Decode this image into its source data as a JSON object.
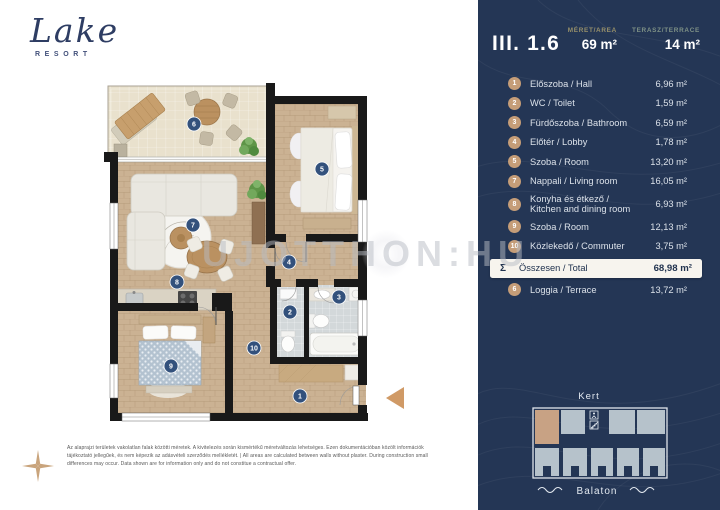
{
  "brand": {
    "name": "Lake",
    "sub": "RESORT"
  },
  "unit": {
    "id": "III. 1.6",
    "area_label": "MÉRET/AREA",
    "area_value": "69 m²",
    "terrace_label": "TERASZ/TERRACE",
    "terrace_value": "14 m²"
  },
  "rooms": [
    {
      "num": "1",
      "label": "Előszoba / Hall",
      "area": "6,96 m²"
    },
    {
      "num": "2",
      "label": "WC / Toilet",
      "area": "1,59 m²"
    },
    {
      "num": "3",
      "label": "Fürdőszoba / Bathroom",
      "area": "6,59 m²"
    },
    {
      "num": "4",
      "label": "Előtér / Lobby",
      "area": "1,78 m²"
    },
    {
      "num": "5",
      "label": "Szoba / Room",
      "area": "13,20 m²"
    },
    {
      "num": "7",
      "label": "Nappali / Living room",
      "area": "16,05 m²"
    },
    {
      "num": "8",
      "label": "Konyha  és étkező /\nKitchen and dining room",
      "area": "6,93 m²"
    },
    {
      "num": "9",
      "label": "Szoba / Room",
      "area": "12,13 m²"
    },
    {
      "num": "10",
      "label": "Közlekedő / Commuter",
      "area": "3,75 m²"
    }
  ],
  "total": {
    "symbol": "Σ",
    "label": "Összesen / Total",
    "area": "68,98 m²"
  },
  "loggia": {
    "num": "6",
    "label": "Loggia / Terrace",
    "area": "13,72 m²"
  },
  "plan": {
    "badges": [
      "1",
      "2",
      "3",
      "4",
      "5",
      "6",
      "7",
      "8",
      "9",
      "10"
    ]
  },
  "minimap": {
    "top_label": "Kert",
    "bottom_label": "Balaton"
  },
  "watermark": "UJOTTHON:HU",
  "disclaimer": "Az alaprajzi területek vakolatlan falak közötti méretek. A kivitelezés során kismértékű méretváltozás lehetséges. Ezen dokumentációban közölt információk tájékoztató jellegűek, és nem képezik az adásvételi szerződés mellékletét. | All areas are calculated between walls without plaster. During construction small differences may occur. Data shown are for information only and do not constitue a contractual offer.",
  "colors": {
    "panel_bg": "#243655",
    "badge": "#c59d78",
    "area_label": "#97906a",
    "terrace_label": "#7f9286",
    "total_box": "#f7f4ee",
    "plan_badge": "#33517c",
    "entrance_arrow": "#d09a66",
    "minimap_highlight": "#c8a284",
    "minimap_room": "#b6c2cb",
    "logo_navy": "#2e3d63"
  }
}
